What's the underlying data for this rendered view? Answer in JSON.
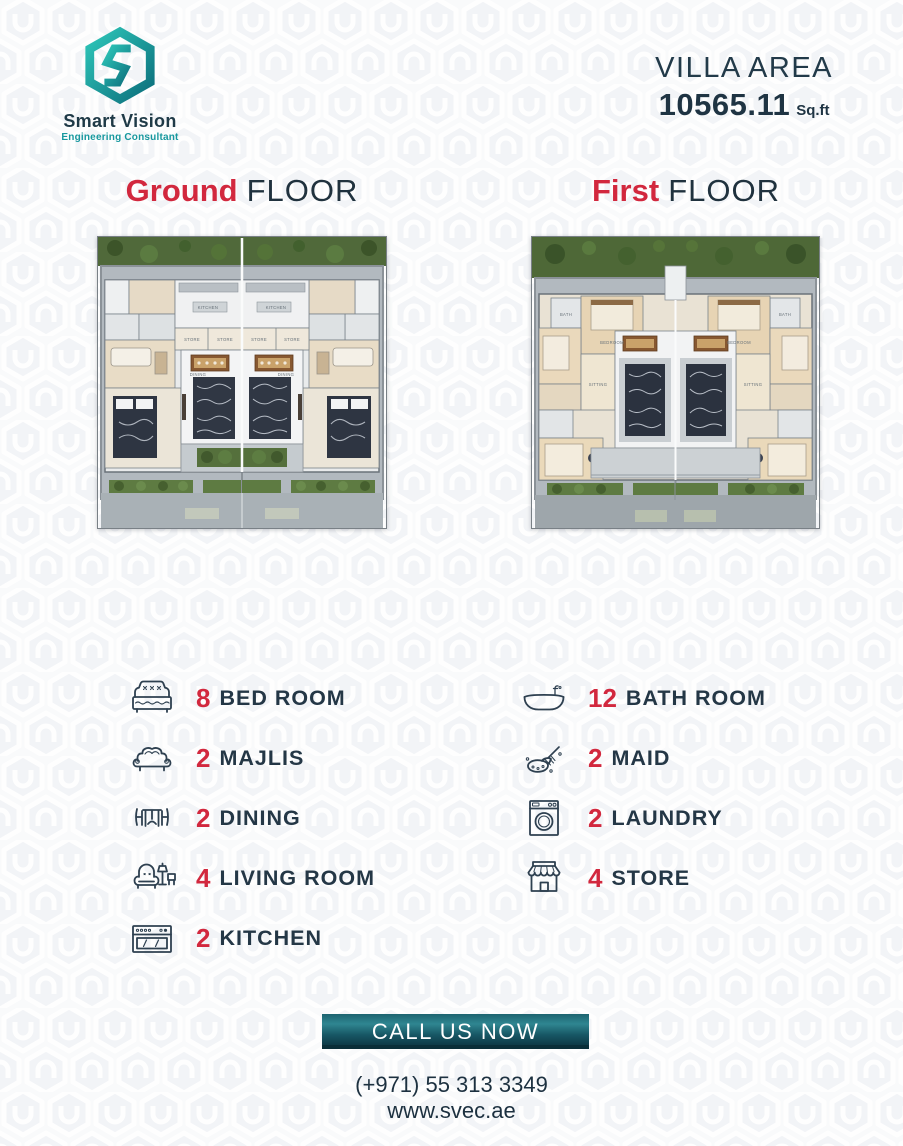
{
  "colors": {
    "accent_red": "#d2283e",
    "dark_navy": "#223746",
    "teal": "#17989e",
    "button_top": "#2f8691",
    "button_bottom": "#0d3944"
  },
  "logo": {
    "brand": "Smart Vision",
    "tagline": "Engineering Consultant",
    "icon": "smart-vision-hexagon-s-logo"
  },
  "villa_area": {
    "label": "VILLA AREA",
    "value": "10565.11",
    "unit": "Sq.ft"
  },
  "floors": [
    {
      "highlight": "Ground",
      "rest": "FLOOR"
    },
    {
      "highlight": "First",
      "rest": "FLOOR"
    }
  ],
  "plans": {
    "ground": {
      "labels": {
        "kitchen": "KITCHEN",
        "store": "STORE",
        "dining": "DINING"
      }
    },
    "first": {
      "labels": {
        "bedroom": "BEDROOM",
        "bath": "BATH",
        "sitting": "SITTING"
      }
    }
  },
  "amenities": {
    "left": [
      {
        "icon": "bed-icon",
        "count": "8",
        "label": "BED ROOM"
      },
      {
        "icon": "sofa-icon",
        "count": "2",
        "label": "MAJLIS"
      },
      {
        "icon": "dining-icon",
        "count": "2",
        "label": "DINING"
      },
      {
        "icon": "living-room-icon",
        "count": "4",
        "label": "LIVING ROOM"
      },
      {
        "icon": "kitchen-icon",
        "count": "2",
        "label": "KITCHEN"
      }
    ],
    "right": [
      {
        "icon": "bathtub-icon",
        "count": "12",
        "label": "BATH ROOM"
      },
      {
        "icon": "maid-icon",
        "count": "2",
        "label": "MAID"
      },
      {
        "icon": "laundry-icon",
        "count": "2",
        "label": "LAUNDRY"
      },
      {
        "icon": "store-icon",
        "count": "4",
        "label": "STORE"
      }
    ]
  },
  "cta": {
    "label": "CALL US NOW"
  },
  "contact": {
    "phone": "(+971) 55 313 3349",
    "website": "www.svec.ae"
  }
}
